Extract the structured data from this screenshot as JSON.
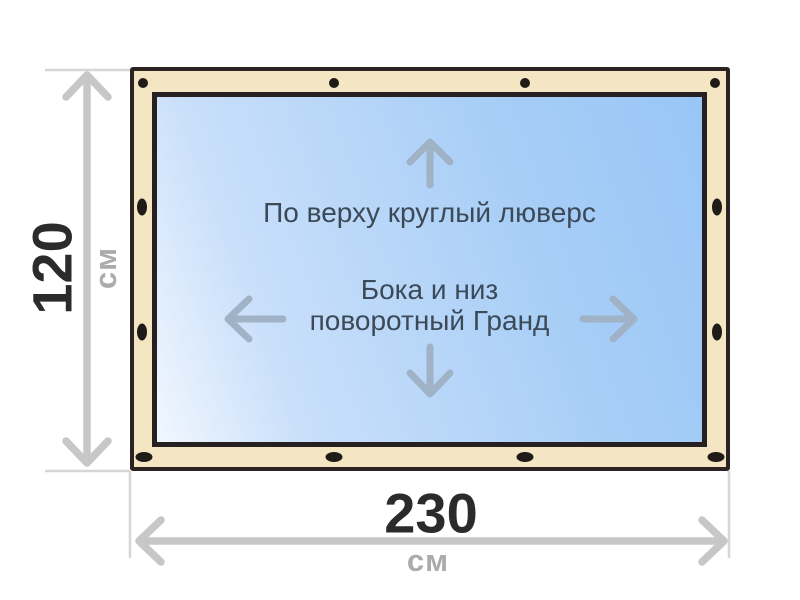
{
  "banner": {
    "labels": {
      "top_edge_note": "По верху круглый люверс",
      "center_note_line1": "Бока и низ",
      "center_note_line2": "поворотный Гранд"
    },
    "dimensions": {
      "height": {
        "value": "120",
        "unit": "см"
      },
      "width": {
        "value": "230",
        "unit": "см"
      }
    },
    "grommets": {
      "top_style": "round",
      "side_style": "oval",
      "bottom_style": "oval",
      "top_count": 4,
      "left_count": 2,
      "right_count": 2,
      "bottom_count": 4
    },
    "colors": {
      "frame_fill": "#F4E6C2",
      "frame_border": "#2A2321",
      "grommet_fill": "#1E1B19",
      "canvas_gradient_start": "#99C6F7",
      "canvas_gradient_end": "#F1F7FE",
      "inner_arrow": "#9FB2C6",
      "dimension_arrow": "#C7C7C7",
      "extension_line": "#D6D6D6",
      "value_text": "#2B2B2B",
      "unit_text": "#ABABAB",
      "note_text": "#3C4A58"
    }
  }
}
